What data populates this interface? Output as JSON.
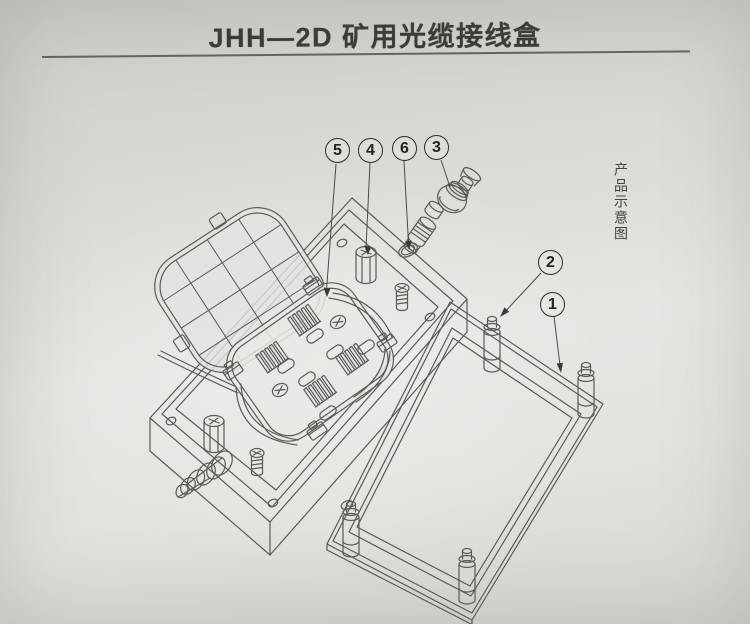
{
  "title": "JHH—2D 矿用光缆接线盒",
  "side_label": "产品示意图",
  "callouts": [
    {
      "label": "1"
    },
    {
      "label": "2"
    },
    {
      "label": "3"
    },
    {
      "label": "4"
    },
    {
      "label": "5"
    },
    {
      "label": "6"
    }
  ],
  "colors": {
    "ink": "#5c5a57",
    "callout_ink": "#2d2d2d",
    "paper_light": "#e7e5e1",
    "paper_dark": "#cfccc7"
  }
}
